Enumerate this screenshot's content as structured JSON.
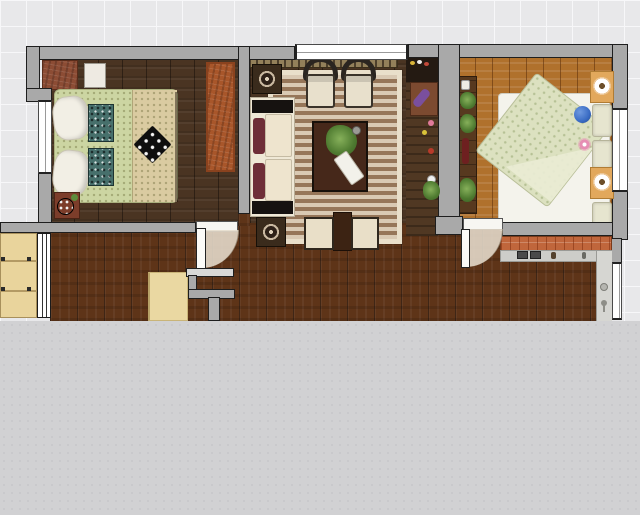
{
  "canvas": {
    "type": "floor-plan-2d-view",
    "grid_visible": true,
    "grid_cell_px": 26,
    "plan_area_bottom_px": 321,
    "empty_canvas_below": true
  },
  "colors": {
    "grid_bg": "#e8e8ea",
    "grid_line": "#f7f7f9",
    "canvas_gray": "#d1d1d3",
    "canvas_dot": "#c6c6c9",
    "wall_fill": "#a9a9a9",
    "wall_edge": "#1e1e1e",
    "wood_dark": "#4a3422",
    "wood_hall": "#5e3418",
    "wood_oak": "#b0712c",
    "rug_light": "#d9c9b3",
    "rug_dark": "#967659",
    "rug_border": "#e9dfca",
    "bed1_blanket": "#ccd5a2",
    "bed1_runner": "#dacba1",
    "pillow_white": "#f2efe5",
    "teal": "#47706c",
    "mattress": "#f4f3ec",
    "duvet_green": "#dce1c0",
    "duvet_dot": "#b6c195",
    "sofa_cream": "#efe8d6",
    "sofa_black": "#161210",
    "maroon": "#6e2e38",
    "table_brown": "#46281a",
    "ottoman": "#e9dfc8",
    "counter_orange": "#c0663c",
    "counter_gray": "#cdcdc9",
    "sink_gray": "#d6d6d2",
    "nightstand_tan": "#e2a85c",
    "wardrobe_tan": "#e9d49c",
    "rust_rug": "#a8562a",
    "dresser_red": "#8c4c34",
    "speaker_dark": "#3a2b1c",
    "chair_dark": "#2b2520",
    "chair_cushion": "#e8e0cc",
    "console_tan": "#93805a",
    "sideboard_dark": "#503823",
    "arc_fill": "#e7ddcd",
    "blue_ball": "#3a6cc4",
    "pink_flower": "#e68fb4",
    "cream_table": "#ead8a2"
  },
  "scene": {
    "rooms": [
      {
        "name": "bedroom-left",
        "floor": "dark-walnut-planks",
        "furniture": [
          "double-bed-green-bedding",
          "white-nightstand",
          "red-dresser",
          "rust-rug",
          "lamp-side-table"
        ],
        "window": "west-wall"
      },
      {
        "name": "living-room",
        "floor": "dark-walnut-planks",
        "furniture": [
          "striped-area-rug",
          "cream-sofa-maroon-pillows",
          "armchair-1",
          "armchair-2",
          "coffee-table-with-plant",
          "ottoman-1",
          "ottoman-2",
          "side-speaker-table-top",
          "side-speaker-table-bottom",
          "wall-console",
          "sideboard-column"
        ],
        "window": "north-wall"
      },
      {
        "name": "bedroom-right",
        "floor": "oak-planks",
        "furniture": [
          "double-bed-white-mattress-green-duvet",
          "nightstand-flower-top",
          "nightstand-flower-bottom",
          "wall-shelf-with-plants",
          "blue-ball",
          "pink-flower"
        ],
        "window": "east-wall"
      },
      {
        "name": "hallway",
        "floor": "mahogany-planks",
        "furniture": [
          "wardrobe-tan",
          "entry-door-leaf",
          "cream-side-table",
          "partition-walls"
        ]
      },
      {
        "name": "kitchen",
        "floor": "mahogany-planks",
        "furniture": [
          "tiled-counter",
          "stove-burners",
          "sink-counter",
          "sink-drain",
          "faucet"
        ],
        "window": "east-wall"
      }
    ],
    "doors": [
      {
        "name": "bedroom-left-door",
        "state": "open-with-swing-arc"
      },
      {
        "name": "bedroom-right-door",
        "state": "open-with-swing-arc"
      },
      {
        "name": "entry-door",
        "state": "open-against-wall"
      }
    ],
    "windows_count": 4
  }
}
